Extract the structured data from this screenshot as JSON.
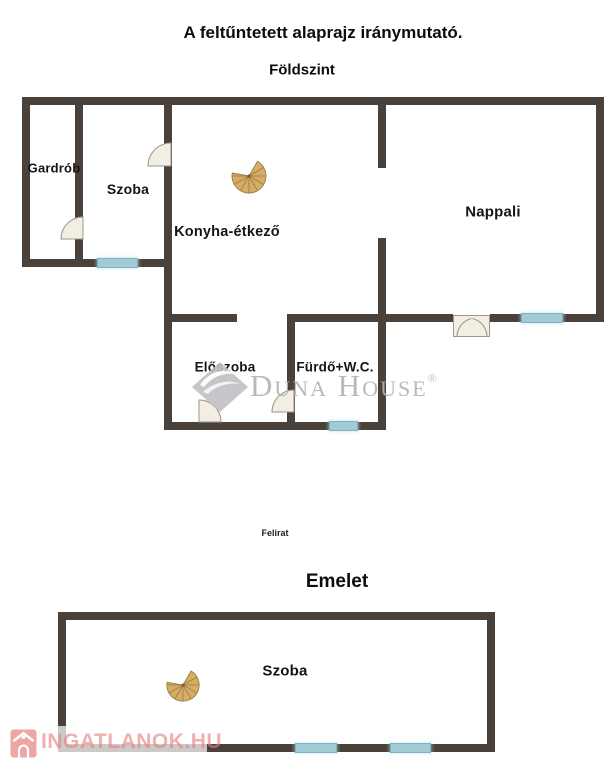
{
  "header": {
    "disclaimer": "A feltűntetett alaprajz iránymutató."
  },
  "ground_floor": {
    "title": "Földszint",
    "rooms": {
      "gardrob": "Gardrób",
      "szoba": "Szoba",
      "konyha": "Konyha-étkező",
      "nappali": "Nappali",
      "eloszoba": "Előszoba",
      "furdo": "Fürdő+W.C."
    }
  },
  "middle": {
    "caption": "Felirat"
  },
  "upper_floor": {
    "title": "Emelet",
    "rooms": {
      "szoba": "Szoba"
    }
  },
  "watermarks": {
    "duna_house": {
      "name": "Duna House",
      "registered": "®"
    },
    "ingatlanok": {
      "text": "INGATLANOK.HU"
    }
  },
  "icons": {
    "ground_stair": "spiral-staircase",
    "upper_stair": "spiral-staircase",
    "duna_logo": "diamond-wave",
    "ingatlanok_logo": "house"
  },
  "colors": {
    "wall": "#4a413b",
    "window": "#a3cbd6",
    "stair_fill": "#d4ad67",
    "door_fill": "#f3eee3",
    "duna_gray": "#b5b3b7",
    "logo_pink": "#e98f8f"
  }
}
